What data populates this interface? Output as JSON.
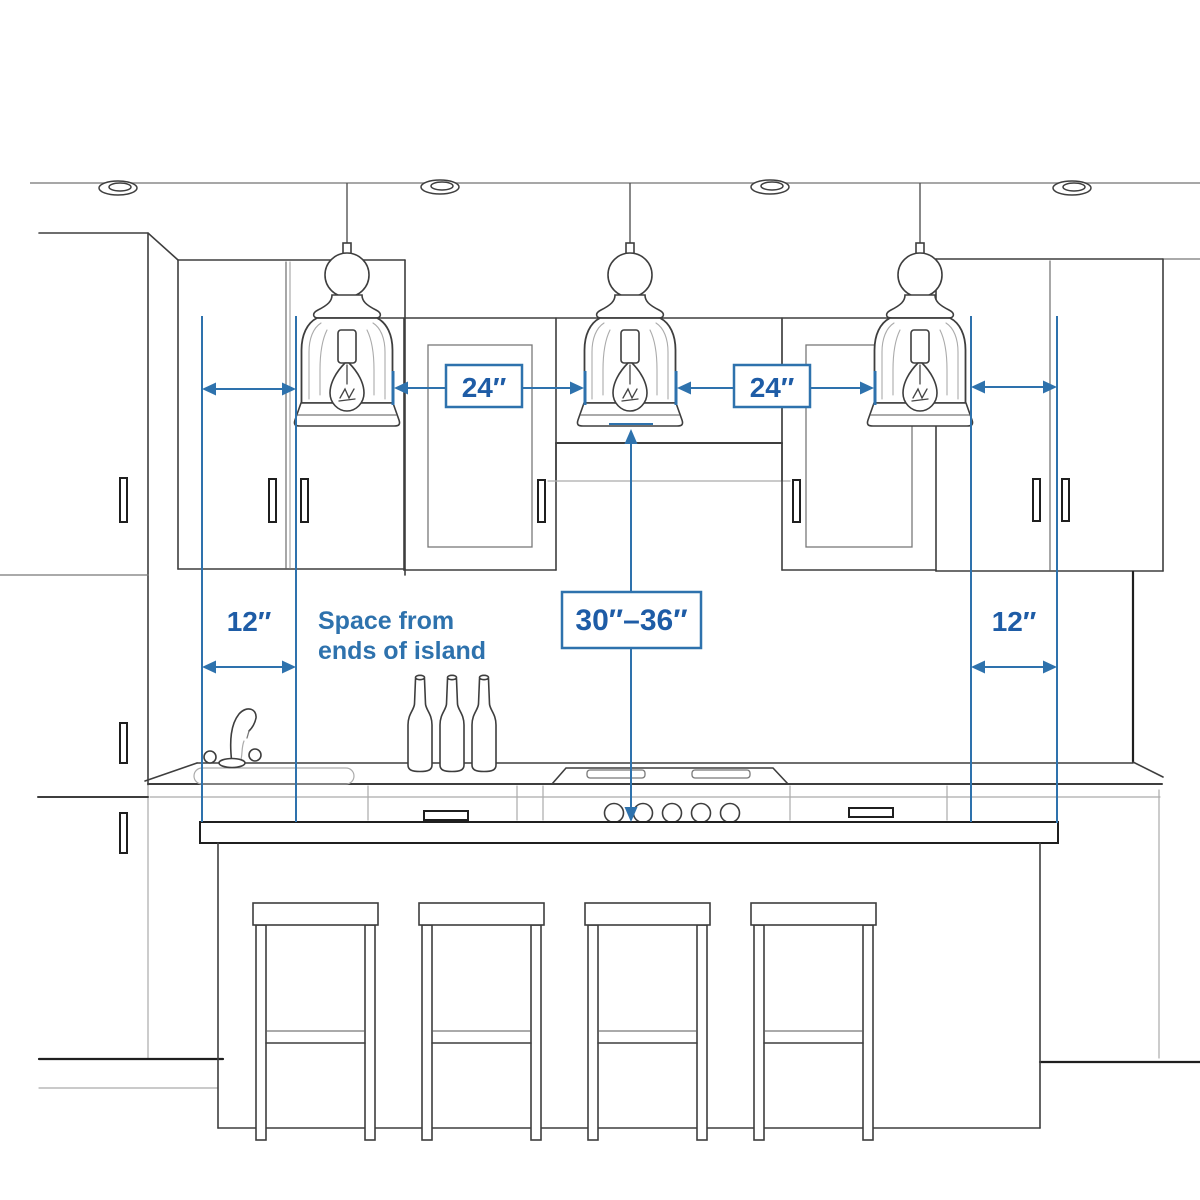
{
  "colors": {
    "background": "#ffffff",
    "dimension_line": "#2e72ad",
    "label_text": "#1e5ca6",
    "sketch_dark": "#3e3e3e",
    "sketch_mid": "#787878",
    "sketch_faint": "#ababab",
    "sketch_black": "#1f1f1f"
  },
  "dimensions": {
    "pendant_gap_left": {
      "label": "24″"
    },
    "pendant_gap_right": {
      "label": "24″"
    },
    "island_end_left": {
      "label": "12″"
    },
    "island_end_right": {
      "label": "12″"
    },
    "pendant_height": {
      "label": "30″–36″"
    }
  },
  "note": {
    "line1": "Space from",
    "line2": "ends of island"
  }
}
